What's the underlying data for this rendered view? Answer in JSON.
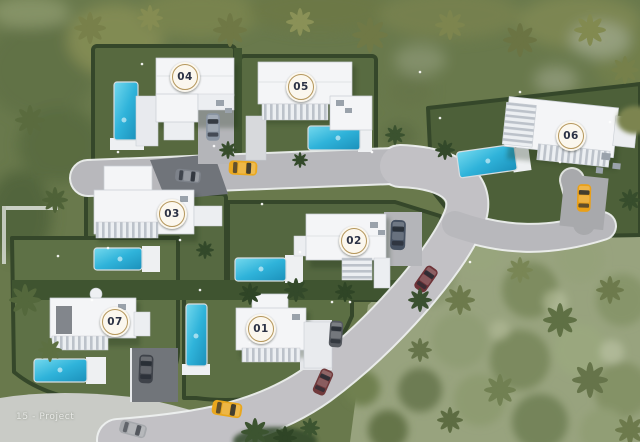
{
  "watermark": "15 - Project",
  "villas": [
    {
      "number": "01"
    },
    {
      "number": "02"
    },
    {
      "number": "03"
    },
    {
      "number": "04"
    },
    {
      "number": "05"
    },
    {
      "number": "06"
    },
    {
      "number": "07"
    }
  ],
  "badge": {
    "background": "#fbf7ee",
    "ring_color": "#b5975c",
    "text_color": "#2c3245"
  },
  "palette": {
    "pool_water": "#2fb3da",
    "road": "#b8b8bc",
    "hedge_dark": "#3c5030",
    "lawn": "#5a6d42",
    "villa_white": "#f4f5f7",
    "car_yellow": "#eaa81f",
    "car_maroon": "#6e3338",
    "car_blue": "#475262"
  }
}
